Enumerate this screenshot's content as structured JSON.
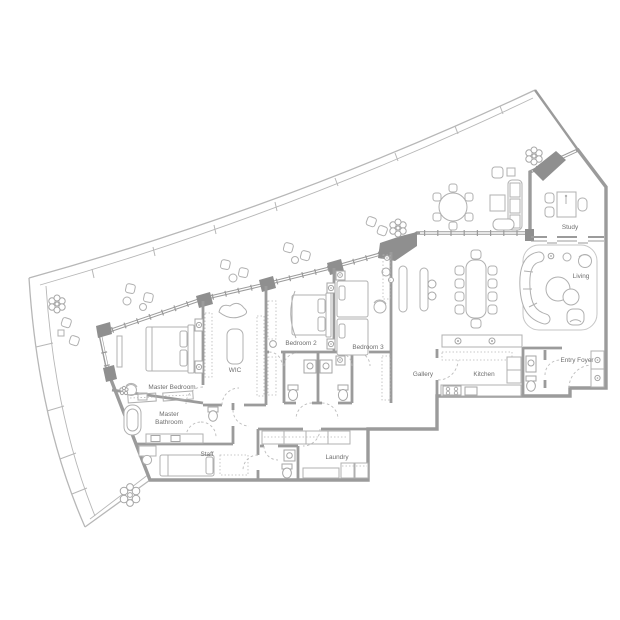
{
  "floorplan": {
    "type": "residential-apartment-floor-plan",
    "colors": {
      "background": "#ffffff",
      "walls": "#9b9b9b",
      "wall_piers": "#8f8f8f",
      "furniture_lines": "#b0b0b0",
      "railing": "#b7b7b7",
      "door_swings": "#bdbdbd",
      "text": "#6e6e6e"
    },
    "rooms": [
      {
        "id": "master-bedroom",
        "label": "Master Bedroom",
        "furniture": [
          "king-bed",
          "nightstands",
          "lamps",
          "dresser",
          "armchair",
          "side-table",
          "closet-rods"
        ]
      },
      {
        "id": "wic",
        "label": "WIC",
        "furniture": [
          "island-bench",
          "settee",
          "wardrobe-rails"
        ]
      },
      {
        "id": "bedroom-2",
        "label": "Bedroom 2",
        "furniture": [
          "bed",
          "canopy",
          "nightstands",
          "lamps",
          "wardrobe-rails"
        ]
      },
      {
        "id": "bedroom-3",
        "label": "Bedroom 3",
        "furniture": [
          "twin-bed",
          "twin-bed",
          "nightstands",
          "armchair",
          "wardrobe-rail"
        ]
      },
      {
        "id": "master-bathroom",
        "label": "Master Bathroom",
        "lines": [
          "Master",
          "Bathroom"
        ],
        "furniture": [
          "bathtub",
          "double-vanity",
          "toilet",
          "shower"
        ]
      },
      {
        "id": "staff",
        "label": "Staff",
        "furniture": [
          "single-bed",
          "desk",
          "chair",
          "wardrobe"
        ]
      },
      {
        "id": "laundry",
        "label": "Laundry",
        "furniture": [
          "closet-run",
          "washer",
          "dryer",
          "sink"
        ]
      },
      {
        "id": "gallery",
        "label": "Gallery",
        "furniture": [
          "console-table",
          "console-table",
          "stools"
        ]
      },
      {
        "id": "kitchen",
        "label": "Kitchen",
        "furniture": [
          "island-counter",
          "cooktop",
          "sink",
          "refrigerator",
          "cabinets"
        ]
      },
      {
        "id": "entry-foyer",
        "label": "Entry Foyer",
        "furniture": [
          "entry-door",
          "closet",
          "powder-room"
        ]
      },
      {
        "id": "study",
        "label": "Study",
        "furniture": [
          "desk",
          "desk-chair",
          "guest-chairs"
        ]
      },
      {
        "id": "living",
        "label": "Living",
        "furniture": [
          "curved-sectional-sofa",
          "round-coffee-tables",
          "armchairs",
          "rug"
        ]
      }
    ],
    "shared_spaces": {
      "dining": [
        "dining-table",
        "10-chairs"
      ],
      "terrace": [
        "railing",
        "planters",
        "round-table-6-chairs",
        "lounge-sofa-set",
        "chair-groups",
        "plants"
      ]
    },
    "plants_count": 4
  }
}
